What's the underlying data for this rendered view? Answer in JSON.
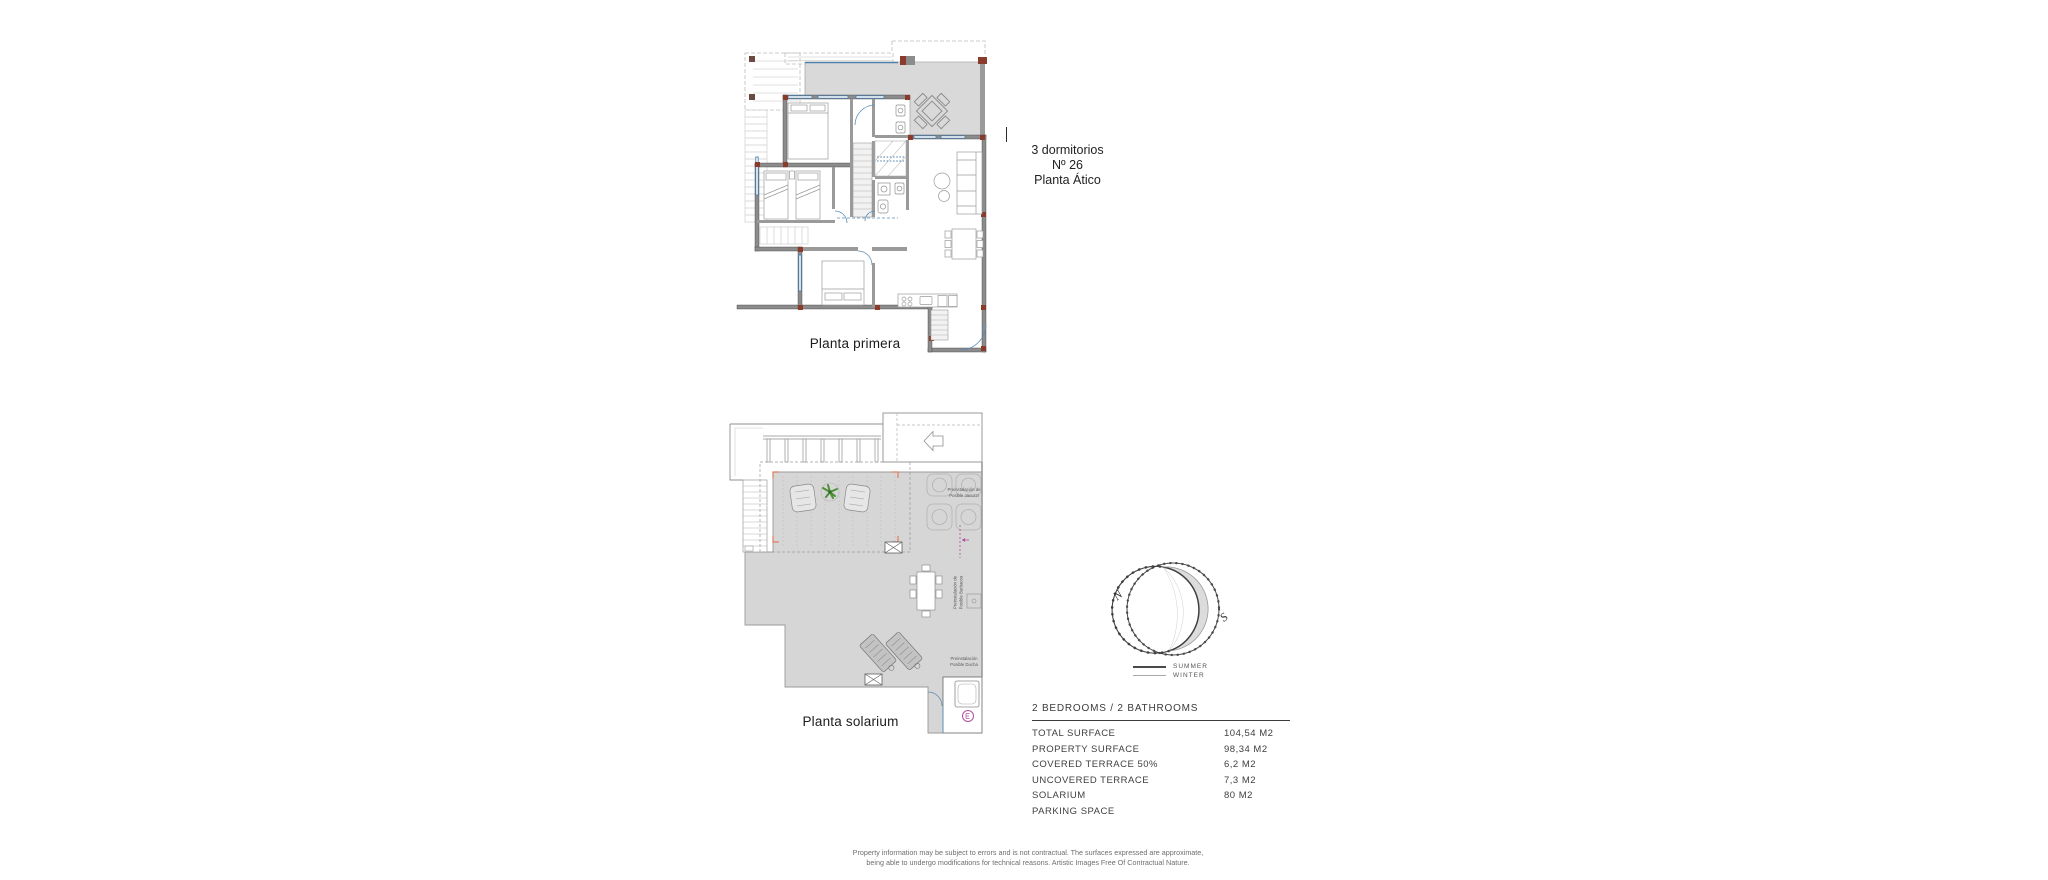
{
  "colors": {
    "terrace_gray": "#d9d9d9",
    "deck_gray": "#d6d6d6",
    "wall_gray": "#8c8c8c",
    "column_red": "#8a3b2b",
    "window_blue": "#4d82b0",
    "pergola_corner_orange": "#dd7f5f",
    "marker_magenta": "#b0509e",
    "plant_green": "#4e8f3a"
  },
  "unit_header": {
    "line1": "3 dormitorios",
    "line2": "Nº 26",
    "line3": "Planta Ático"
  },
  "upper_plan": {
    "label": "Planta primera"
  },
  "lower_plan": {
    "label": "Planta solarium",
    "annotations": {
      "jacuzzi": {
        "line1": "Preinstalación de",
        "line2": "Posible Jacuzzi"
      },
      "barbacoa": {
        "line1": "Preinstalación de",
        "line2": "Posible Barbacoa"
      },
      "ducha": {
        "line1": "Preinstalación",
        "line2": "Posible Ducha"
      }
    }
  },
  "compass": {
    "north_label": "N",
    "south_label": "S",
    "legend_summer": "SUMMER",
    "legend_winter": "WINTER"
  },
  "surface_table": {
    "title": "2 BEDROOMS / 2 BATHROOMS",
    "rows": [
      {
        "label": "TOTAL SURFACE",
        "value": "104,54 M2"
      },
      {
        "label": "PROPERTY SURFACE",
        "value": "98,34 M2"
      },
      {
        "label": "COVERED TERRACE 50%",
        "value": "6,2 M2"
      },
      {
        "label": "UNCOVERED TERRACE",
        "value": "7,3 M2"
      },
      {
        "label": "SOLARIUM",
        "value": "80 M2"
      },
      {
        "label": "PARKING SPACE",
        "value": ""
      }
    ]
  },
  "footer": {
    "line1": "Property information may be subject to errors and is not contractual. The surfaces expressed are approximate,",
    "line2": "being able to undergo modifications for technical reasons. Artistic Images Free Of Contractual Nature."
  }
}
